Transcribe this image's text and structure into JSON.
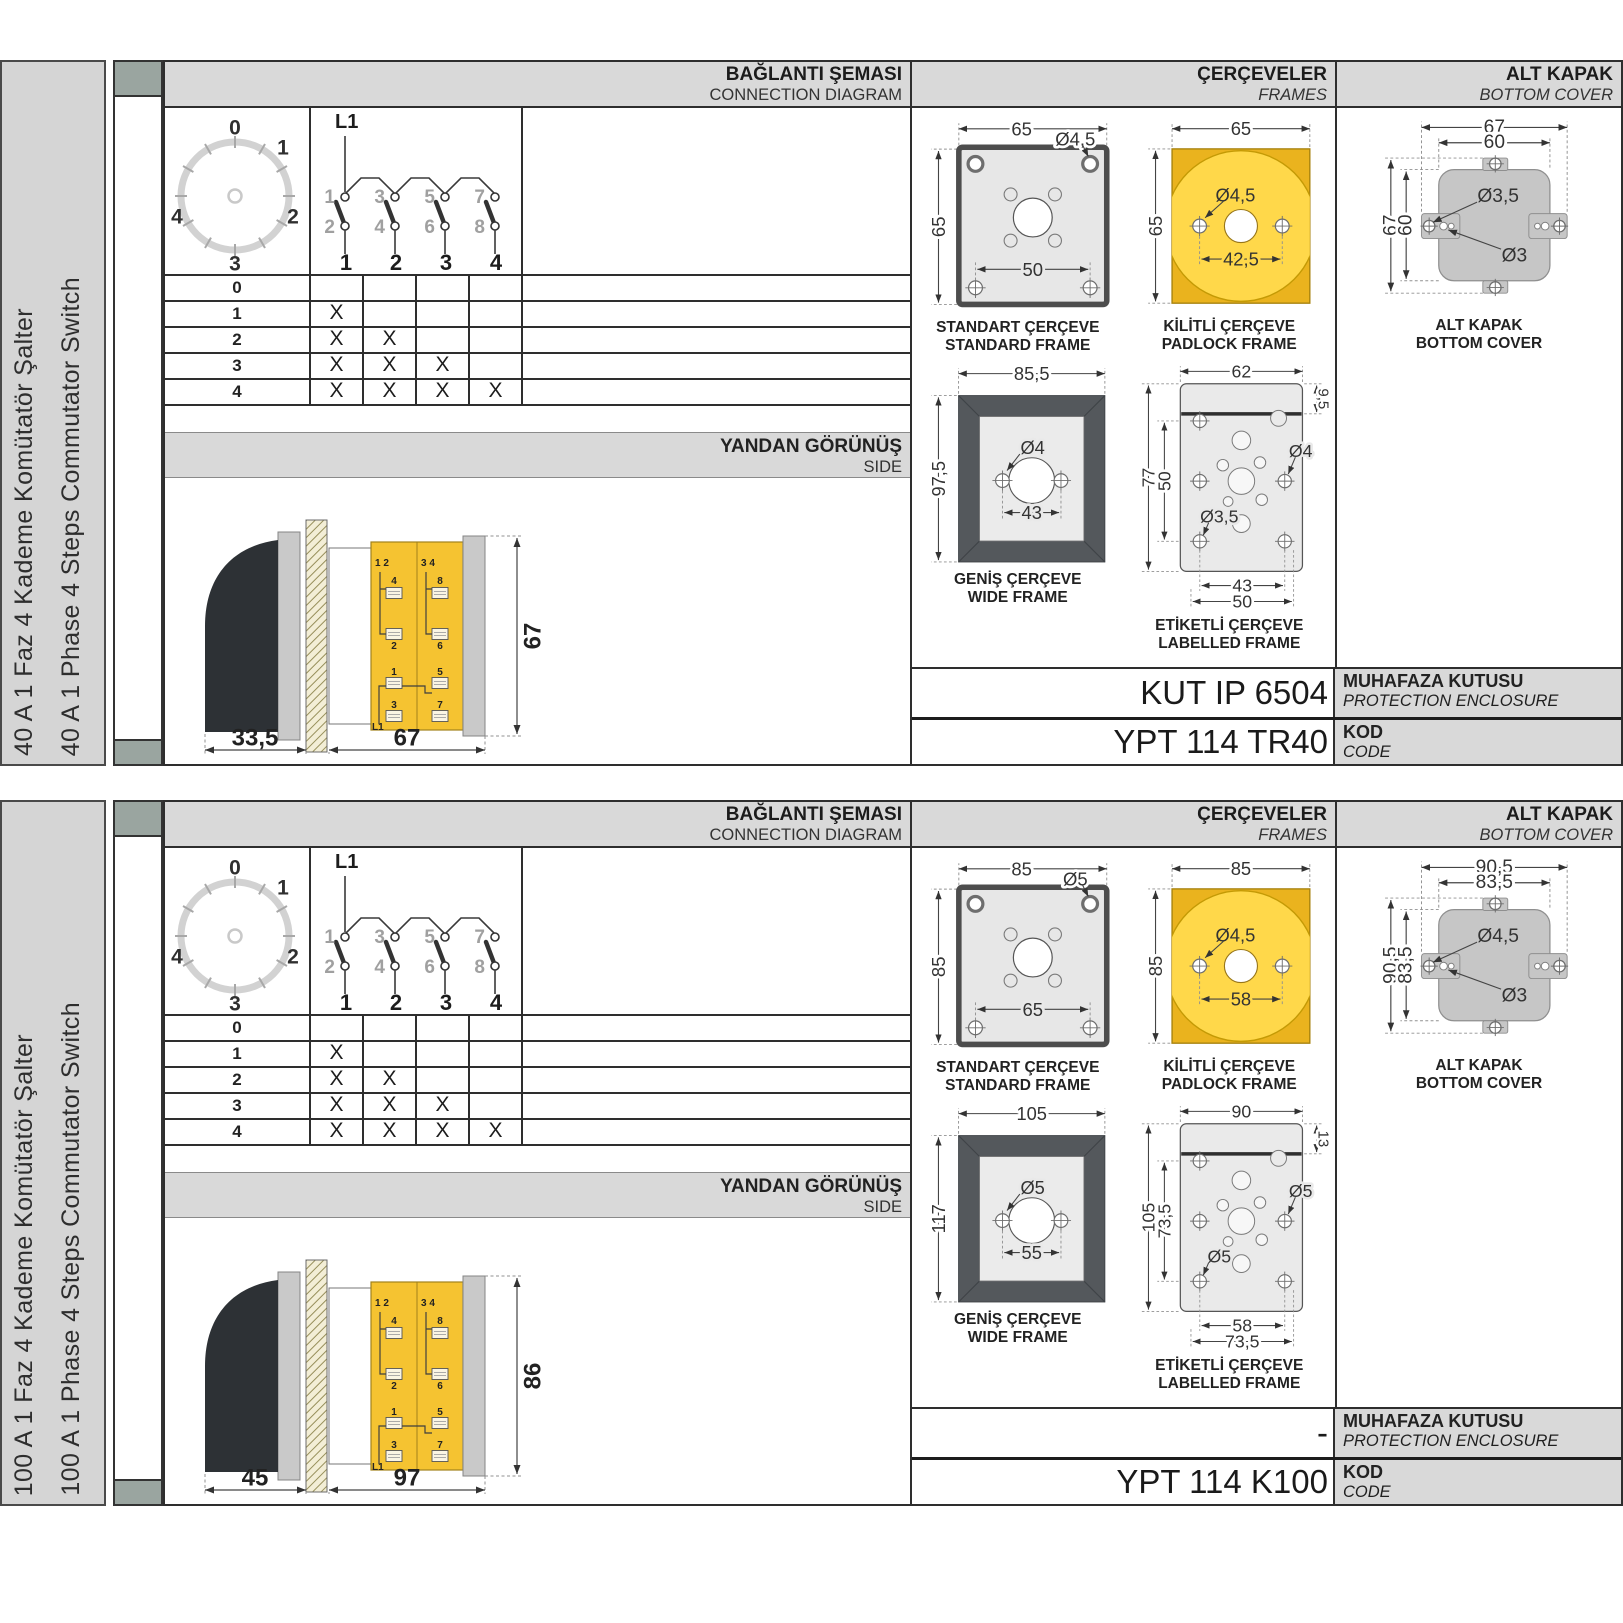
{
  "common": {
    "headers": {
      "connection_tr": "BAĞLANTI ŞEMASI",
      "connection_en": "CONNECTION DIAGRAM",
      "frames_tr": "ÇERÇEVELER",
      "frames_en": "FRAMES",
      "cover_tr": "ALT KAPAK",
      "cover_en": "BOTTOM COVER",
      "side_tr": "YANDAN GÖRÜNÜŞ",
      "side_en": "SIDE",
      "enclosure_tr": "MUHAFAZA KUTUSU",
      "enclosure_en": "PROTECTION ENCLOSURE",
      "code_tr": "KOD",
      "code_en": "CODE"
    },
    "captions": {
      "std_tr": "STANDART ÇERÇEVE",
      "std_en": "STANDARD FRAME",
      "pad_tr": "KİLİTLİ ÇERÇEVE",
      "pad_en": "PADLOCK FRAME",
      "wide_tr": "GENİŞ ÇERÇEVE",
      "wide_en": "WIDE FRAME",
      "lab_tr": "ETİKETLİ ÇERÇEVE",
      "lab_en": "LABELLED FRAME",
      "cover_tr": "ALT KAPAK",
      "cover_en": "BOTTOM COVER"
    },
    "dial": {
      "p0": "0",
      "p1": "1",
      "p2": "2",
      "p3": "3",
      "p4": "4"
    },
    "contacts": {
      "line": "L1",
      "top": [
        "1",
        "3",
        "5",
        "7"
      ],
      "bottom": [
        "2",
        "4",
        "6",
        "8"
      ],
      "poles": [
        "1",
        "2",
        "3",
        "4"
      ]
    },
    "table": {
      "row_labels": [
        "0",
        "1",
        "2",
        "3",
        "4"
      ],
      "marks": [
        [
          "",
          "",
          "",
          ""
        ],
        [
          "X",
          "",
          "",
          ""
        ],
        [
          "X",
          "X",
          "",
          ""
        ],
        [
          "X",
          "X",
          "X",
          ""
        ],
        [
          "X",
          "X",
          "X",
          "X"
        ]
      ]
    },
    "sideview": {
      "t12": "1 2",
      "t34": "3 4",
      "t4": "4",
      "t8": "8",
      "t2": "2",
      "t6": "6",
      "t1": "1",
      "t5": "5",
      "t3": "3",
      "t7": "7",
      "l1": "L1"
    },
    "colors": {
      "accent_yellow": "#f5c331",
      "padlock_yellow": "#ffd84a",
      "band_gray": "#d9d9d9",
      "spine_green": "#9aa5a0",
      "wide_frame_dark": "#54585c"
    }
  },
  "panels": [
    {
      "title_tr": "40 A 1 Faz 4 Kademe Komütatör Şalter",
      "title_en": "40 A 1 Phase 4 Steps Commutator Switch",
      "side": {
        "front_depth": "33,5",
        "body_depth": "67",
        "height": "67"
      },
      "std": {
        "w": "65",
        "h": "65",
        "hole": "Ø4,5",
        "pitch": "50"
      },
      "pad": {
        "w": "65",
        "h": "65",
        "hole": "Ø4,5",
        "pitch": "42,5"
      },
      "wide": {
        "w": "85,5",
        "h": "97,5",
        "hole": "Ø4",
        "pitch": "43"
      },
      "lab": {
        "w": "62",
        "band": "9,5",
        "h": "77",
        "h2": "50",
        "hole_left": "Ø3,5",
        "hole_right": "Ø4",
        "pitch1": "43",
        "pitch2": "50"
      },
      "cover": {
        "w1": "67",
        "w2": "60",
        "h1": "67",
        "h2": "60",
        "hole1": "Ø3,5",
        "hole2": "Ø3"
      },
      "enclosure_code": "KUT IP 6504",
      "code": "YPT 114 TR40"
    },
    {
      "title_tr": "100 A 1 Faz 4 Kademe Komütatör Şalter",
      "title_en": "100 A 1 Phase 4 Steps Commutator Switch",
      "side": {
        "front_depth": "45",
        "body_depth": "97",
        "height": "86"
      },
      "std": {
        "w": "85",
        "h": "85",
        "hole": "Ø5",
        "pitch": "65"
      },
      "pad": {
        "w": "85",
        "h": "85",
        "hole": "Ø4,5",
        "pitch": "58"
      },
      "wide": {
        "w": "105",
        "h": "117",
        "hole": "Ø5",
        "pitch": "55"
      },
      "lab": {
        "w": "90",
        "band": "13",
        "h": "105",
        "h2": "73,5",
        "hole_left": "Ø5",
        "hole_right": "Ø5",
        "pitch1": "58",
        "pitch2": "73,5"
      },
      "cover": {
        "w1": "90,5",
        "w2": "83,5",
        "h1": "90,5",
        "h2": "83,5",
        "hole1": "Ø4,5",
        "hole2": "Ø3"
      },
      "enclosure_code": "-",
      "code": "YPT 114 K100"
    }
  ]
}
